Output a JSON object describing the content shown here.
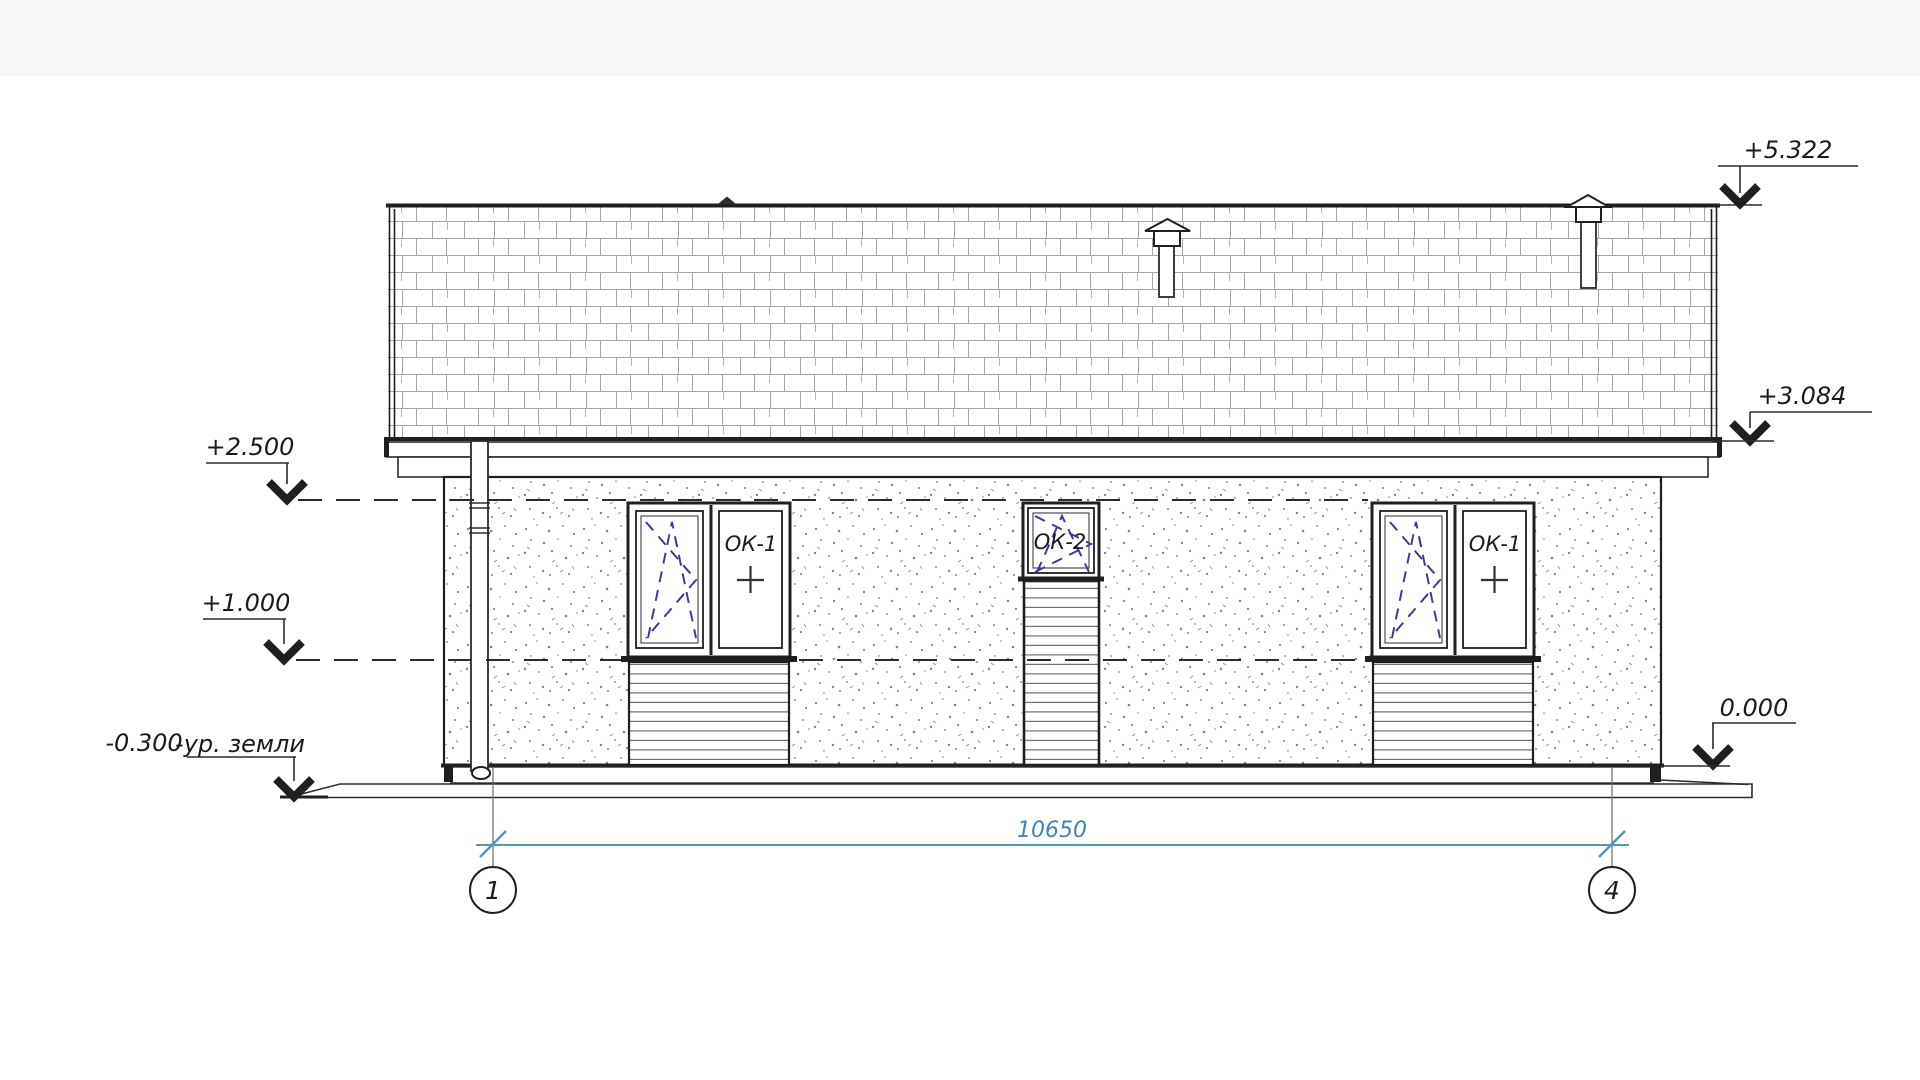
{
  "levels": {
    "ridge": "+5.322",
    "eaves": "+3.084",
    "upper": "+2.500",
    "middle": "+1.000",
    "zero": "0.000",
    "ground_value": "-0.300",
    "ground_note": "-ур. земли"
  },
  "openings": {
    "window_left_label": "ОК-1",
    "window_center_label": "ОК-2",
    "window_right_label": "ОК-1"
  },
  "dimensions": {
    "overall_width": "10650"
  },
  "axes": {
    "first": "1",
    "last": "4"
  },
  "colors": {
    "dimension_blue": "#4a99c7",
    "opening_symbol_blue": "#3c3c96",
    "line_dark": "#1f1f1f"
  }
}
